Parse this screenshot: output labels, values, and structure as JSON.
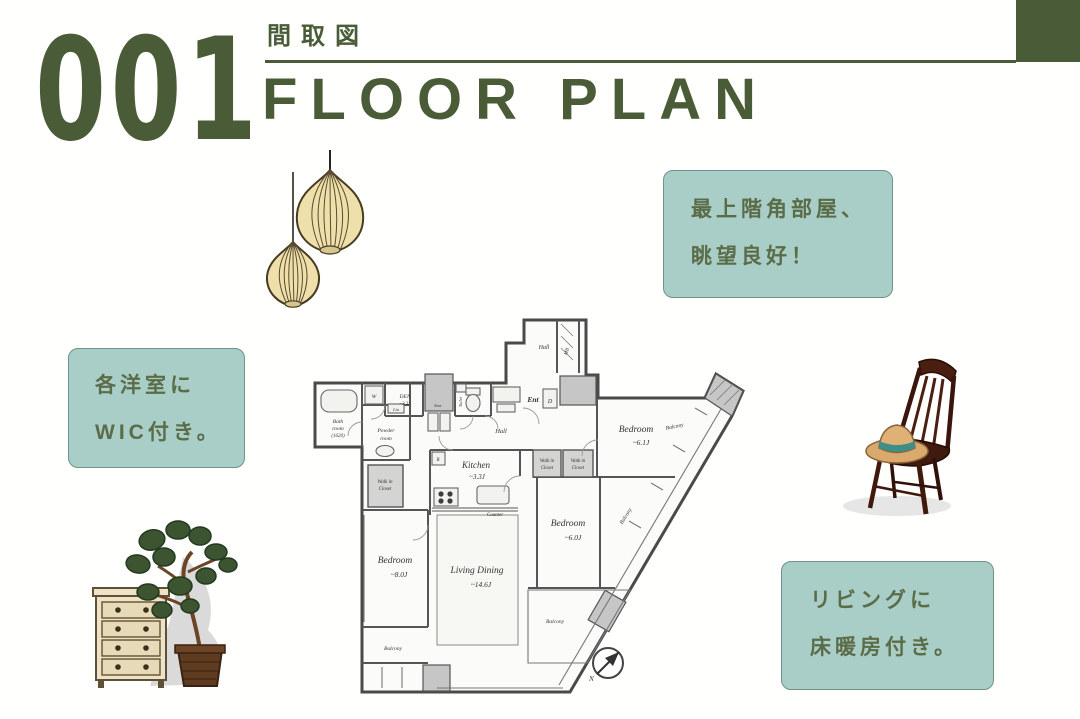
{
  "colors": {
    "accent_green": "#4a5c37",
    "callout_bg": "#a9cec7",
    "callout_text": "#5b6c49"
  },
  "header": {
    "number": "001",
    "subtitle_jp": "間取図",
    "title_en": "FLOOR PLAN"
  },
  "callouts": {
    "left": {
      "line1": "各洋室に",
      "line2": "WIC付き。"
    },
    "top_right": {
      "line1": "最上階角部屋、",
      "line2": "眺望良好！"
    },
    "bottom_right": {
      "line1": "リビングに",
      "line2": "床暖房付き。"
    }
  },
  "floor_plan": {
    "labels": {
      "bath_l1": "Bath",
      "bath_l2": "room",
      "bath_l3": "(1620)",
      "w": "W",
      "lin": "Lin",
      "den_l1": "DEN",
      "den_l2": "~3.3J",
      "stor": "Stor",
      "toilet": "Toilet",
      "powder_l1": "Powder",
      "powder_l2": "room",
      "hall_top": "Hall",
      "mb": "MB",
      "d": "D",
      "ent": "Ent",
      "hall_center": "Hall",
      "kitchen_l1": "Kitchen",
      "kitchen_l2": "~3.3J",
      "r": "R",
      "counter": "Counter",
      "wic_l1": "Walk in",
      "wic_l2": "Closet",
      "bedroom_right_l1": "Bedroom",
      "bedroom_right_l2": "~6.1J",
      "bedroom_mid_l1": "Bedroom",
      "bedroom_mid_l2": "~6.0J",
      "bedroom_left_l1": "Bedroom",
      "bedroom_left_l2": "~8.0J",
      "living_l1": "Living Dining",
      "living_l2": "~14.6J",
      "balcony": "Balcony",
      "north": "N"
    }
  },
  "decorations": [
    {
      "name": "pendant-lamps"
    },
    {
      "name": "wooden-chair-with-straw-hat"
    },
    {
      "name": "potted-plant-and-dresser"
    }
  ]
}
